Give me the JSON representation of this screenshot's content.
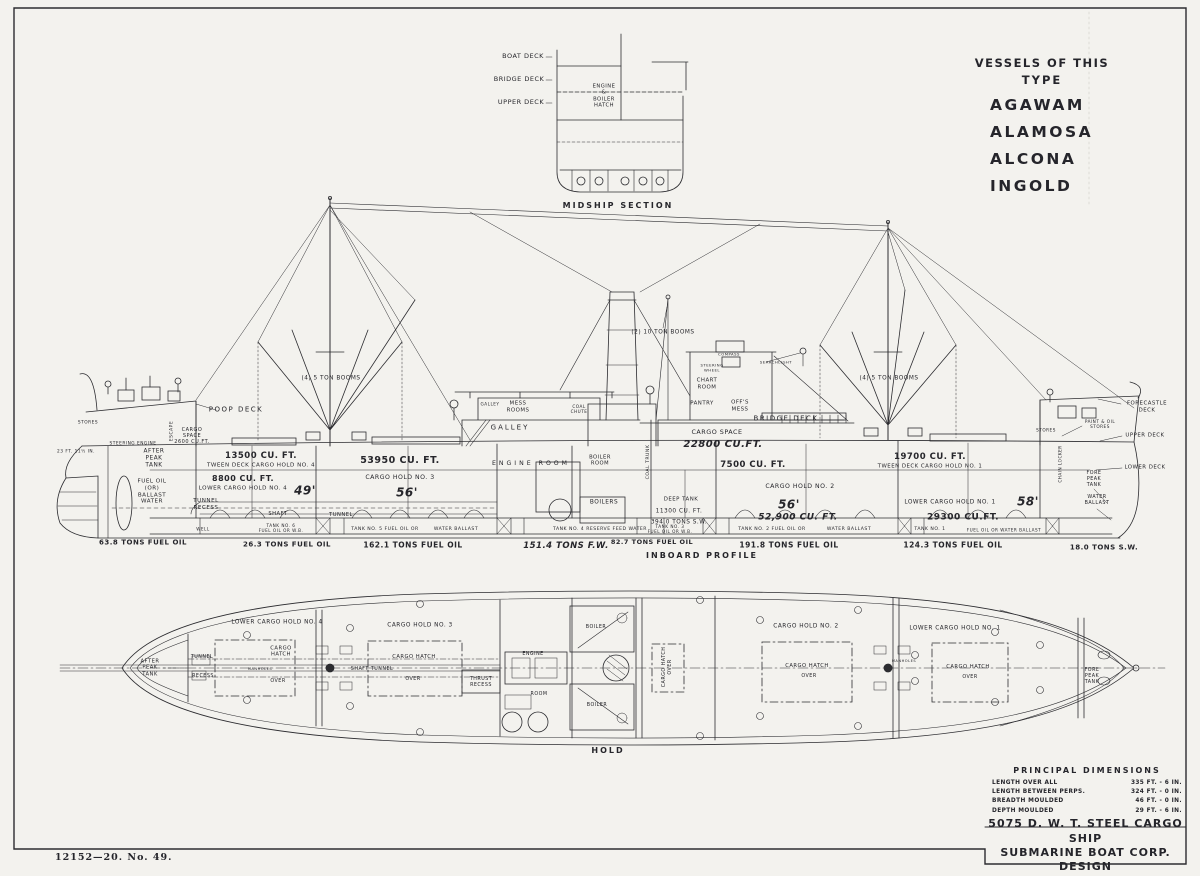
{
  "sheet": {
    "imprint": "12152—20.      No. 49.",
    "ink_color": "#2c2c30",
    "paper_color": "#f3f2ee"
  },
  "vessels_panel": {
    "heading_line1": "VESSELS OF THIS",
    "heading_line2": "TYPE",
    "names": [
      "AGAWAM",
      "ALAMOSA",
      "ALCONA",
      "INGOLD"
    ]
  },
  "principal_dimensions": {
    "title": "PRINCIPAL DIMENSIONS",
    "rows": [
      {
        "label": "LENGTH OVER ALL",
        "value": "335 FT. - 6 IN."
      },
      {
        "label": "LENGTH BETWEEN PERPS.",
        "value": "324 FT. - 0 IN."
      },
      {
        "label": "BREADTH MOULDED",
        "value": "46 FT. - 0 IN."
      },
      {
        "label": "DEPTH MOULDED",
        "value": "29 FT. - 6 IN."
      }
    ]
  },
  "title_block": {
    "line1": "5075 D. W. T. STEEL CARGO SHIP",
    "line2": "SUBMARINE BOAT CORP. DESIGN"
  },
  "labels": [
    {
      "n": "midship-label-boat-deck",
      "t": "BOAT DECK",
      "x": 523,
      "y": 57,
      "s": 6.5
    },
    {
      "n": "midship-label-bridge-deck",
      "t": "BRIDGE DECK",
      "x": 519,
      "y": 80,
      "s": 6.5
    },
    {
      "n": "midship-label-upper-deck",
      "t": "UPPER DECK",
      "x": 521,
      "y": 103,
      "s": 6.5
    },
    {
      "n": "midship-label-engine-boiler-hatch",
      "t": "ENGINE\n&\nBOILER\nHATCH",
      "x": 604,
      "y": 96,
      "s": 5.2
    },
    {
      "n": "midship-section-caption",
      "t": "MIDSHIP SECTION",
      "x": 618,
      "y": 206,
      "s": 8,
      "ls": 2,
      "b": 1
    },
    {
      "n": "profile-draft-mark",
      "t": "23 FT. 11½ IN.",
      "x": 76,
      "y": 452,
      "s": 4.3
    },
    {
      "n": "profile-stores-aft",
      "t": "STORES",
      "x": 88,
      "y": 423,
      "s": 4.3
    },
    {
      "n": "profile-steering-engine",
      "t": "STEERING ENGINE",
      "x": 133,
      "y": 444,
      "s": 4.3
    },
    {
      "n": "profile-poop-deck",
      "t": "POOP DECK",
      "x": 236,
      "y": 410,
      "s": 7,
      "ls": 1.5
    },
    {
      "n": "profile-escape",
      "t": "ESCAPE",
      "x": 172,
      "y": 431,
      "s": 4.5,
      "r": -90
    },
    {
      "n": "profile-cargo-space-aft",
      "t": "CARGO\nSPACE\n2600 CU.FT.",
      "x": 192,
      "y": 436,
      "s": 5
    },
    {
      "n": "profile-after-peak-tank",
      "t": "AFTER\nPEAK\nTANK",
      "x": 154,
      "y": 459,
      "s": 5.8
    },
    {
      "n": "profile-fuel-oil-ballast",
      "t": "FUEL OIL\n(OR)\nBALLAST\nWATER",
      "x": 152,
      "y": 492,
      "s": 5.6
    },
    {
      "n": "profile-tween4-cuft",
      "t": "13500 CU. FT.",
      "x": 261,
      "y": 456,
      "s": 8.5,
      "b": 1
    },
    {
      "n": "profile-tween4",
      "t": "TWEEN DECK CARGO HOLD NO. 4",
      "x": 261,
      "y": 466,
      "s": 5.6
    },
    {
      "n": "profile-lower4-cuft",
      "t": "8800 CU. FT.",
      "x": 243,
      "y": 479,
      "s": 8,
      "b": 1
    },
    {
      "n": "profile-lower4",
      "t": "LOWER CARGO HOLD NO. 4",
      "x": 243,
      "y": 489,
      "s": 5.6
    },
    {
      "n": "profile-hold4-length",
      "t": "49'",
      "x": 305,
      "y": 491,
      "s": 12,
      "i": 1,
      "b": 1
    },
    {
      "n": "profile-tunnel-recess",
      "t": "TUNNEL\nRECESS",
      "x": 206,
      "y": 505,
      "s": 5.6
    },
    {
      "n": "profile-shaft",
      "t": "SHAFT",
      "x": 278,
      "y": 514,
      "s": 5.2
    },
    {
      "n": "profile-tunnel",
      "t": "TUNNEL",
      "x": 341,
      "y": 515,
      "s": 5.2
    },
    {
      "n": "profile-well-aft",
      "t": "WELL",
      "x": 203,
      "y": 529,
      "s": 4.2
    },
    {
      "n": "profile-tank6-strip",
      "t": "TANK NO. 6\nFUEL OIL OR W.B.",
      "x": 281,
      "y": 528,
      "s": 4.2
    },
    {
      "n": "profile-tons-fo-afterpeak",
      "t": "63.8 TONS FUEL OIL",
      "x": 143,
      "y": 543,
      "s": 7,
      "b": 1
    },
    {
      "n": "profile-tons-fo-tank6",
      "t": "26.3 TONS FUEL OIL",
      "x": 287,
      "y": 545,
      "s": 7,
      "b": 1
    },
    {
      "n": "profile-hold3-cuft",
      "t": "53950 CU. FT.",
      "x": 400,
      "y": 461,
      "s": 9.5,
      "b": 1
    },
    {
      "n": "profile-hold3",
      "t": "CARGO HOLD NO. 3",
      "x": 400,
      "y": 478,
      "s": 6.2
    },
    {
      "n": "profile-hold3-length",
      "t": "56'",
      "x": 407,
      "y": 493,
      "s": 12,
      "i": 1,
      "b": 1
    },
    {
      "n": "profile-tank5-strip",
      "t": "TANK NO. 5 FUEL OIL OR",
      "x": 385,
      "y": 530,
      "s": 4.6
    },
    {
      "n": "profile-tank5-strip-2",
      "t": "WATER BALLAST",
      "x": 456,
      "y": 530,
      "s": 4.6
    },
    {
      "n": "profile-tons-fo-tank5",
      "t": "162.1 TONS FUEL OIL",
      "x": 413,
      "y": 545,
      "s": 7.5,
      "b": 1
    },
    {
      "n": "profile-galley-small",
      "t": "GALLEY",
      "x": 490,
      "y": 404,
      "s": 4.2
    },
    {
      "n": "profile-mess-rooms",
      "t": "MESS\nROOMS",
      "x": 518,
      "y": 407,
      "s": 5.4
    },
    {
      "n": "profile-galley",
      "t": "GALLEY",
      "x": 510,
      "y": 428,
      "s": 7,
      "ls": 2
    },
    {
      "n": "profile-coal-chute",
      "t": "COAL\nCHUTE",
      "x": 579,
      "y": 409,
      "s": 4.2
    },
    {
      "n": "profile-engine-room",
      "t": "ENGINE ROOM",
      "x": 531,
      "y": 464,
      "s": 6.2,
      "ls": 3
    },
    {
      "n": "profile-boiler-room",
      "t": "BOILER\nROOM",
      "x": 600,
      "y": 461,
      "s": 5.2
    },
    {
      "n": "profile-boilers",
      "t": "BOILERS",
      "x": 604,
      "y": 503,
      "s": 5.8
    },
    {
      "n": "profile-coal-trunk",
      "t": "COAL TRUNK",
      "x": 649,
      "y": 462,
      "s": 4.6,
      "r": -90
    },
    {
      "n": "profile-booms-aft",
      "t": "(4) 5 TON BOOMS",
      "x": 331,
      "y": 379,
      "s": 5.8
    },
    {
      "n": "profile-booms-mid",
      "t": "(2) 10 TON BOOMS",
      "x": 663,
      "y": 333,
      "s": 5.8
    },
    {
      "n": "profile-booms-fore",
      "t": "(4) 5 TON BOOMS",
      "x": 889,
      "y": 379,
      "s": 5.8
    },
    {
      "n": "profile-compass",
      "t": "COMPASS",
      "x": 729,
      "y": 355,
      "s": 3.8
    },
    {
      "n": "profile-steering-wheel",
      "t": "STEERING\nWHEEL",
      "x": 712,
      "y": 368,
      "s": 3.8
    },
    {
      "n": "profile-chart-room",
      "t": "CHART\nROOM",
      "x": 707,
      "y": 384,
      "s": 5.4
    },
    {
      "n": "profile-searchlight",
      "t": "SEARCHLIGHT",
      "x": 776,
      "y": 363,
      "s": 3.8
    },
    {
      "n": "profile-pantry",
      "t": "PANTRY",
      "x": 702,
      "y": 404,
      "s": 5.4
    },
    {
      "n": "profile-offs-mess",
      "t": "OFF'S\nMESS",
      "x": 740,
      "y": 406,
      "s": 5.4
    },
    {
      "n": "profile-bridge-deck",
      "t": "BRIDGE DECK",
      "x": 786,
      "y": 419,
      "s": 7,
      "ls": 1.5
    },
    {
      "n": "profile-cargo-space-mid",
      "t": "CARGO SPACE",
      "x": 717,
      "y": 433,
      "s": 6.4
    },
    {
      "n": "profile-cargo-space-mid-cuft",
      "t": "22800 CU.FT.",
      "x": 723,
      "y": 445,
      "s": 10,
      "i": 1,
      "b": 1
    },
    {
      "n": "profile-tween2-cuft",
      "t": "7500 CU. FT.",
      "x": 753,
      "y": 465,
      "s": 8.5,
      "b": 1
    },
    {
      "n": "profile-hold2",
      "t": "CARGO HOLD NO. 2",
      "x": 800,
      "y": 487,
      "s": 6.2
    },
    {
      "n": "profile-hold2-length",
      "t": "56'",
      "x": 789,
      "y": 505,
      "s": 12,
      "i": 1,
      "b": 1
    },
    {
      "n": "profile-hold2-cuft",
      "t": "52,900 CU. FT.",
      "x": 798,
      "y": 518,
      "s": 9,
      "i": 1,
      "b": 1
    },
    {
      "n": "profile-deep-tank",
      "t": "DEEP TANK",
      "x": 681,
      "y": 500,
      "s": 5.4
    },
    {
      "n": "profile-deep-tank-cuft",
      "t": "11300 CU. FT.",
      "x": 679,
      "y": 512,
      "s": 5.8
    },
    {
      "n": "profile-deep-tank-sw",
      "t": "394.0 TONS S.W.",
      "x": 679,
      "y": 523,
      "s": 5.8
    },
    {
      "n": "profile-tank4-strip",
      "t": "TANK NO. 4 RESERVE FEED WATER",
      "x": 600,
      "y": 530,
      "s": 4.6
    },
    {
      "n": "profile-tons-fw",
      "t": "151.4 TONS F.W.",
      "x": 566,
      "y": 546,
      "s": 8.5,
      "i": 1,
      "b": 1
    },
    {
      "n": "profile-tank3-strip",
      "t": "TANK NO. 3\nFUEL OIL OR W.B.",
      "x": 670,
      "y": 529,
      "s": 4.2
    },
    {
      "n": "profile-tons-fo-tank3",
      "t": "82.7 TONS FUEL OIL",
      "x": 652,
      "y": 543,
      "s": 6.5,
      "b": 1
    },
    {
      "n": "inboard-profile-caption",
      "t": "INBOARD PROFILE",
      "x": 702,
      "y": 556,
      "s": 8,
      "ls": 2,
      "b": 1
    },
    {
      "n": "profile-tank2-strip",
      "t": "TANK NO. 2 FUEL OIL OR",
      "x": 772,
      "y": 530,
      "s": 4.6
    },
    {
      "n": "profile-tank2-strip-2",
      "t": "WATER BALLAST",
      "x": 849,
      "y": 530,
      "s": 4.6
    },
    {
      "n": "profile-tons-fo-tank2",
      "t": "191.8 TONS FUEL OIL",
      "x": 789,
      "y": 545,
      "s": 7.5,
      "b": 1
    },
    {
      "n": "profile-tween1-cuft",
      "t": "19700 CU. FT.",
      "x": 930,
      "y": 457,
      "s": 8.5,
      "b": 1
    },
    {
      "n": "profile-tween1",
      "t": "TWEEN DECK CARGO HOLD NO. 1",
      "x": 930,
      "y": 467,
      "s": 5.4
    },
    {
      "n": "profile-lower1",
      "t": "LOWER CARGO HOLD NO. 1",
      "x": 950,
      "y": 503,
      "s": 5.8
    },
    {
      "n": "profile-hold1-length",
      "t": "58'",
      "x": 1028,
      "y": 502,
      "s": 12,
      "i": 1,
      "b": 1
    },
    {
      "n": "profile-lower1-cuft",
      "t": "29300 CU.FT.",
      "x": 963,
      "y": 518,
      "s": 9,
      "b": 1
    },
    {
      "n": "profile-tank1-strip",
      "t": "TANK NO. 1",
      "x": 930,
      "y": 530,
      "s": 4.6
    },
    {
      "n": "profile-tank1-strip-2",
      "t": "FUEL OIL OR WATER BALLAST",
      "x": 1004,
      "y": 530,
      "s": 4.2
    },
    {
      "n": "profile-tons-fo-tank1",
      "t": "124.3 TONS FUEL OIL",
      "x": 953,
      "y": 545,
      "s": 7.5,
      "b": 1
    },
    {
      "n": "profile-forecastle-deck",
      "t": "FORECASTLE\nDECK",
      "x": 1147,
      "y": 407,
      "s": 5.4
    },
    {
      "n": "profile-upper-deck-fore",
      "t": "UPPER DECK",
      "x": 1145,
      "y": 436,
      "s": 5.4
    },
    {
      "n": "profile-lower-deck-fore",
      "t": "LOWER DECK",
      "x": 1145,
      "y": 468,
      "s": 5.4
    },
    {
      "n": "profile-paint-oil-stores",
      "t": "PAINT & OIL\nSTORES",
      "x": 1100,
      "y": 424,
      "s": 4.2
    },
    {
      "n": "profile-stores-fore",
      "t": "STORES",
      "x": 1046,
      "y": 430,
      "s": 4.2
    },
    {
      "n": "profile-chain-locker",
      "t": "CHAIN LOCKER",
      "x": 1060,
      "y": 464,
      "s": 4.2,
      "r": -90
    },
    {
      "n": "profile-fore-peak-tank",
      "t": "FORE\nPEAK\nTANK",
      "x": 1094,
      "y": 480,
      "s": 4.8
    },
    {
      "n": "profile-water-ballast-fore",
      "t": "WATER\nBALLAST",
      "x": 1097,
      "y": 501,
      "s": 4.8
    },
    {
      "n": "profile-tons-sw-forepeak",
      "t": "18.0 TONS S.W.",
      "x": 1104,
      "y": 548,
      "s": 7,
      "b": 1
    },
    {
      "n": "plan-after-peak-tank",
      "t": "AFTER\nPEAK\nTANK",
      "x": 150,
      "y": 668,
      "s": 5.2
    },
    {
      "n": "plan-tunnel",
      "t": "TUNNEL",
      "x": 202,
      "y": 658,
      "s": 4.8
    },
    {
      "n": "plan-recess",
      "t": "RECESS",
      "x": 203,
      "y": 677,
      "s": 4.8
    },
    {
      "n": "plan-lower-hold4",
      "t": "LOWER CARGO HOLD NO. 4",
      "x": 277,
      "y": 623,
      "s": 5.8
    },
    {
      "n": "plan-hatch4",
      "t": "CARGO\nHATCH",
      "x": 281,
      "y": 652,
      "s": 5.2
    },
    {
      "n": "plan-manholes-aft",
      "t": "MANHOLES",
      "x": 260,
      "y": 669,
      "s": 3.6
    },
    {
      "n": "plan-hatch4-over",
      "t": "OVER",
      "x": 278,
      "y": 682,
      "s": 4.8
    },
    {
      "n": "plan-hold3",
      "t": "CARGO HOLD NO. 3",
      "x": 420,
      "y": 626,
      "s": 5.8
    },
    {
      "n": "plan-shaft-tunnel",
      "t": "SHAFT TUNNEL",
      "x": 372,
      "y": 670,
      "s": 4.8
    },
    {
      "n": "plan-hatch3",
      "t": "CARGO HATCH",
      "x": 414,
      "y": 657,
      "s": 5.2
    },
    {
      "n": "plan-hatch3-over",
      "t": "OVER",
      "x": 413,
      "y": 680,
      "s": 4.8
    },
    {
      "n": "plan-thrust-recess",
      "t": "THRUST\nRECESS",
      "x": 481,
      "y": 683,
      "s": 4.8
    },
    {
      "n": "plan-engine",
      "t": "ENGINE",
      "x": 533,
      "y": 655,
      "s": 4.8
    },
    {
      "n": "plan-room",
      "t": "ROOM",
      "x": 539,
      "y": 695,
      "s": 4.8
    },
    {
      "n": "plan-boiler-1",
      "t": "BOILER",
      "x": 596,
      "y": 628,
      "s": 4.8
    },
    {
      "n": "plan-boiler-2",
      "t": "BOILER",
      "x": 597,
      "y": 706,
      "s": 4.8
    },
    {
      "n": "plan-hatch-mid",
      "t": "CARGO HATCH\nOVER",
      "x": 668,
      "y": 667,
      "s": 4.8,
      "r": -90
    },
    {
      "n": "plan-hold2",
      "t": "CARGO HOLD NO. 2",
      "x": 806,
      "y": 627,
      "s": 5.8
    },
    {
      "n": "plan-hatch2",
      "t": "CARGO HATCH",
      "x": 807,
      "y": 666,
      "s": 5.2
    },
    {
      "n": "plan-hatch2-over",
      "t": "OVER",
      "x": 809,
      "y": 677,
      "s": 4.8
    },
    {
      "n": "plan-manholes-fore",
      "t": "MANHOLES",
      "x": 904,
      "y": 661,
      "s": 3.6
    },
    {
      "n": "plan-lower-hold1",
      "t": "LOWER CARGO HOLD NO. 1",
      "x": 955,
      "y": 629,
      "s": 5.8
    },
    {
      "n": "plan-hatch1",
      "t": "CARGO HATCH",
      "x": 968,
      "y": 667,
      "s": 5.2
    },
    {
      "n": "plan-hatch1-over",
      "t": "OVER",
      "x": 970,
      "y": 678,
      "s": 4.8
    },
    {
      "n": "plan-fore-peak-tank",
      "t": "FORE\nPEAK\nTANK",
      "x": 1092,
      "y": 677,
      "s": 4.8
    },
    {
      "n": "hold-plan-caption",
      "t": "HOLD",
      "x": 608,
      "y": 751,
      "s": 8,
      "ls": 2,
      "b": 1
    }
  ]
}
